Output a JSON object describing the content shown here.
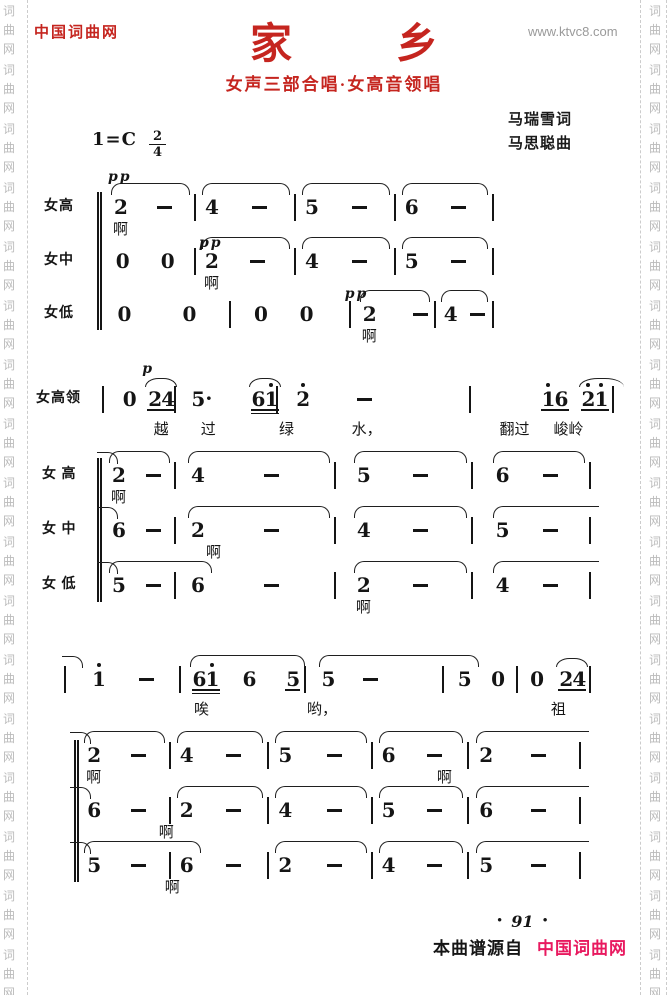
{
  "colors": {
    "brand_red": "#c5251f",
    "footer_pink": "#e8195f",
    "muted_gray": "#9a9a9a"
  },
  "page": {
    "site_name": "中国词曲网",
    "site_url": "www.ktvc8.com",
    "title": "家乡",
    "subtitle": "女声三部合唱·女高音领唱",
    "lyricist": "马瑞雪词",
    "composer": "马思聪曲",
    "key_signature": "1=C",
    "time_numerator": "2",
    "time_denominator": "4",
    "page_number": "91",
    "page_number_bullet": "•",
    "footer_prefix": "本曲谱源自",
    "footer_site": "中国词曲网",
    "watermark_chars": [
      "词",
      "曲",
      "网"
    ]
  },
  "score": {
    "systems": [
      {
        "rows": [
          {
            "label": "女高",
            "measures": [
              [
                "2",
                "-"
              ],
              [
                "4",
                "-"
              ],
              [
                "5",
                "-"
              ],
              [
                "6",
                "-"
              ]
            ],
            "arcs": [
              {
                "m": 0
              },
              {
                "m": 1
              },
              {
                "m": 2
              },
              {
                "m": 3
              }
            ],
            "lyrics": [
              {
                "m": 0,
                "b": 0,
                "t": "啊"
              }
            ],
            "dyns": [
              {
                "m": 0,
                "b": 0,
                "t": "pp"
              }
            ]
          },
          {
            "label": "女中",
            "measures": [
              [
                "0",
                "0"
              ],
              [
                "2",
                "-"
              ],
              [
                "4",
                "-"
              ],
              [
                "5",
                "-"
              ]
            ],
            "arcs": [
              {
                "m": 1
              },
              {
                "m": 2
              },
              {
                "m": 3
              }
            ],
            "lyrics": [
              {
                "m": 1,
                "b": 0,
                "t": "啊"
              }
            ],
            "dyns": [
              {
                "m": 1,
                "b": 0,
                "t": "pp",
                "dy": -14
              }
            ]
          },
          {
            "label": "女低",
            "measures": [
              [
                "0",
                "0"
              ],
              [
                "0",
                "0"
              ],
              [
                "2",
                "-"
              ],
              [
                "4",
                "-"
              ]
            ],
            "arcs": [
              {
                "m": 2
              },
              {
                "m": 3
              }
            ],
            "lyrics": [
              {
                "m": 2,
                "b": 0,
                "t": "啊"
              }
            ],
            "dyns": [
              {
                "m": 2,
                "b": 0,
                "t": "pp",
                "dy": -16,
                "dx": -12
              }
            ]
          }
        ]
      },
      {
        "rows": [
          {
            "label": "女高领",
            "measures": [
              [
                {
                  "t": "0"
                },
                {
                  "t": "24",
                  "u": 1,
                  "arc": true
                }
              ],
              [
                {
                  "t": "5."
                },
                {
                  "t": "61'",
                  "u": 2,
                  "arc": true
                }
              ],
              [
                {
                  "t": "2'"
                },
                {
                  "t": "-"
                }
              ],
              [
                {
                  "t": "1'6",
                  "u": 1
                },
                {
                  "t": "2'1'",
                  "u": 1,
                  "arc": true,
                  "past": true
                }
              ]
            ],
            "arcs": [],
            "lyrics": [
              {
                "m": 0,
                "b": 1,
                "t": "越"
              },
              {
                "m": 1,
                "b": 0,
                "t": "过",
                "dx": 6
              },
              {
                "m": 1,
                "b": 1,
                "t": "绿",
                "dx": 22
              },
              {
                "m": 2,
                "b": 1,
                "t": "水，",
                "dx": 2
              },
              {
                "m": 3,
                "b": 0,
                "t": "翻过",
                "dx": -40
              },
              {
                "m": 3,
                "b": 1,
                "t": "峻岭",
                "dx": -26
              }
            ],
            "dyns": [
              {
                "m": 0,
                "b": 1,
                "t": "p"
              }
            ]
          },
          {
            "label": "女 高",
            "measures": [
              [
                "2",
                "-"
              ],
              [
                "4",
                "-"
              ],
              [
                "5",
                "-"
              ],
              [
                "6",
                "-"
              ]
            ],
            "arcs": [
              {
                "tie": true
              },
              {
                "m": 0
              },
              {
                "m": 1
              },
              {
                "m": 2
              },
              {
                "m": 3
              }
            ],
            "lyrics": [
              {
                "m": 0,
                "b": 0,
                "t": "啊"
              }
            ],
            "dyns": []
          },
          {
            "label": "女 中",
            "measures": [
              [
                "6",
                "-"
              ],
              [
                "2",
                "-"
              ],
              [
                "4",
                "-"
              ],
              [
                "5",
                "-"
              ]
            ],
            "arcs": [
              {
                "tie": true
              },
              {
                "m": 1
              },
              {
                "m": 2
              },
              {
                "m": 3,
                "past": true
              }
            ],
            "lyrics": [
              {
                "m": 1,
                "b": 0,
                "t": "啊",
                "dx": 16
              }
            ],
            "dyns": []
          },
          {
            "label": "女 低",
            "measures": [
              [
                "5",
                "-"
              ],
              [
                "6",
                "-"
              ],
              [
                "2",
                "-"
              ],
              [
                "4",
                "-"
              ]
            ],
            "arcs": [
              {
                "tie": true
              },
              {
                "m": 0,
                "b0": 0,
                "toM": 1,
                "toB": 0
              },
              {
                "m": 2
              },
              {
                "m": 3,
                "past": true
              }
            ],
            "lyrics": [
              {
                "m": 2,
                "b": 0,
                "t": "啊"
              }
            ],
            "dyns": []
          }
        ]
      },
      {
        "rows": [
          {
            "label": "",
            "measures": [
              [
                {
                  "t": "1'"
                },
                {
                  "t": "-"
                }
              ],
              [
                {
                  "t": "61'",
                  "u": 2
                },
                {
                  "t": "6"
                },
                {
                  "t": "5",
                  "u": 1
                }
              ],
              [
                {
                  "t": "5"
                },
                {
                  "t": "-"
                }
              ],
              [
                {
                  "t": "5"
                },
                {
                  "t": "0"
                }
              ],
              [
                {
                  "t": "0"
                },
                {
                  "t": "24",
                  "u": 1,
                  "arc": true
                }
              ]
            ],
            "arcs": [
              {
                "tie": true
              },
              {
                "m": 1,
                "b0": 0,
                "b1": 2
              },
              {
                "m": 2,
                "b0": 0,
                "toM": 3,
                "toB": 0
              }
            ],
            "lyrics": [
              {
                "m": 1,
                "b": 0,
                "t": "唉",
                "dx": -4
              },
              {
                "m": 2,
                "b": 0,
                "t": "哟，",
                "dx": -6
              },
              {
                "m": 4,
                "b": 1,
                "t": "祖",
                "dx": -14
              }
            ],
            "dyns": []
          },
          {
            "label": "",
            "measures": [
              [
                "2",
                "-"
              ],
              [
                "4",
                "-"
              ],
              [
                "5",
                "-"
              ],
              [
                "6",
                "-"
              ],
              [
                "2",
                "-"
              ]
            ],
            "arcs": [
              {
                "tie": true
              },
              {
                "m": 0
              },
              {
                "m": 1
              },
              {
                "m": 2
              },
              {
                "m": 3
              },
              {
                "m": 4,
                "past": true
              }
            ],
            "lyrics": [
              {
                "m": 0,
                "b": 0,
                "t": "啊"
              },
              {
                "m": 3,
                "b": 1,
                "t": "啊",
                "dx": 10
              }
            ],
            "dyns": []
          },
          {
            "label": "",
            "measures": [
              [
                "6",
                "-"
              ],
              [
                "2",
                "-"
              ],
              [
                "4",
                "-"
              ],
              [
                "5",
                "-"
              ],
              [
                "6",
                "-"
              ]
            ],
            "arcs": [
              {
                "tie": true
              },
              {
                "m": 1
              },
              {
                "m": 2
              },
              {
                "m": 3
              },
              {
                "m": 4,
                "past": true
              }
            ],
            "lyrics": [
              {
                "m": 1,
                "b": 0,
                "t": "啊",
                "dx": -20
              }
            ],
            "dyns": []
          },
          {
            "label": "",
            "measures": [
              [
                "5",
                "-"
              ],
              [
                "6",
                "-"
              ],
              [
                "2",
                "-"
              ],
              [
                "4",
                "-"
              ],
              [
                "5",
                "-"
              ]
            ],
            "arcs": [
              {
                "tie": true
              },
              {
                "m": 0,
                "b0": 0,
                "toM": 1,
                "toB": 0
              },
              {
                "m": 2
              },
              {
                "m": 3
              },
              {
                "m": 4,
                "past": true
              }
            ],
            "lyrics": [
              {
                "m": 1,
                "b": 0,
                "t": "啊",
                "dx": -14
              }
            ],
            "dyns": []
          }
        ]
      }
    ]
  }
}
